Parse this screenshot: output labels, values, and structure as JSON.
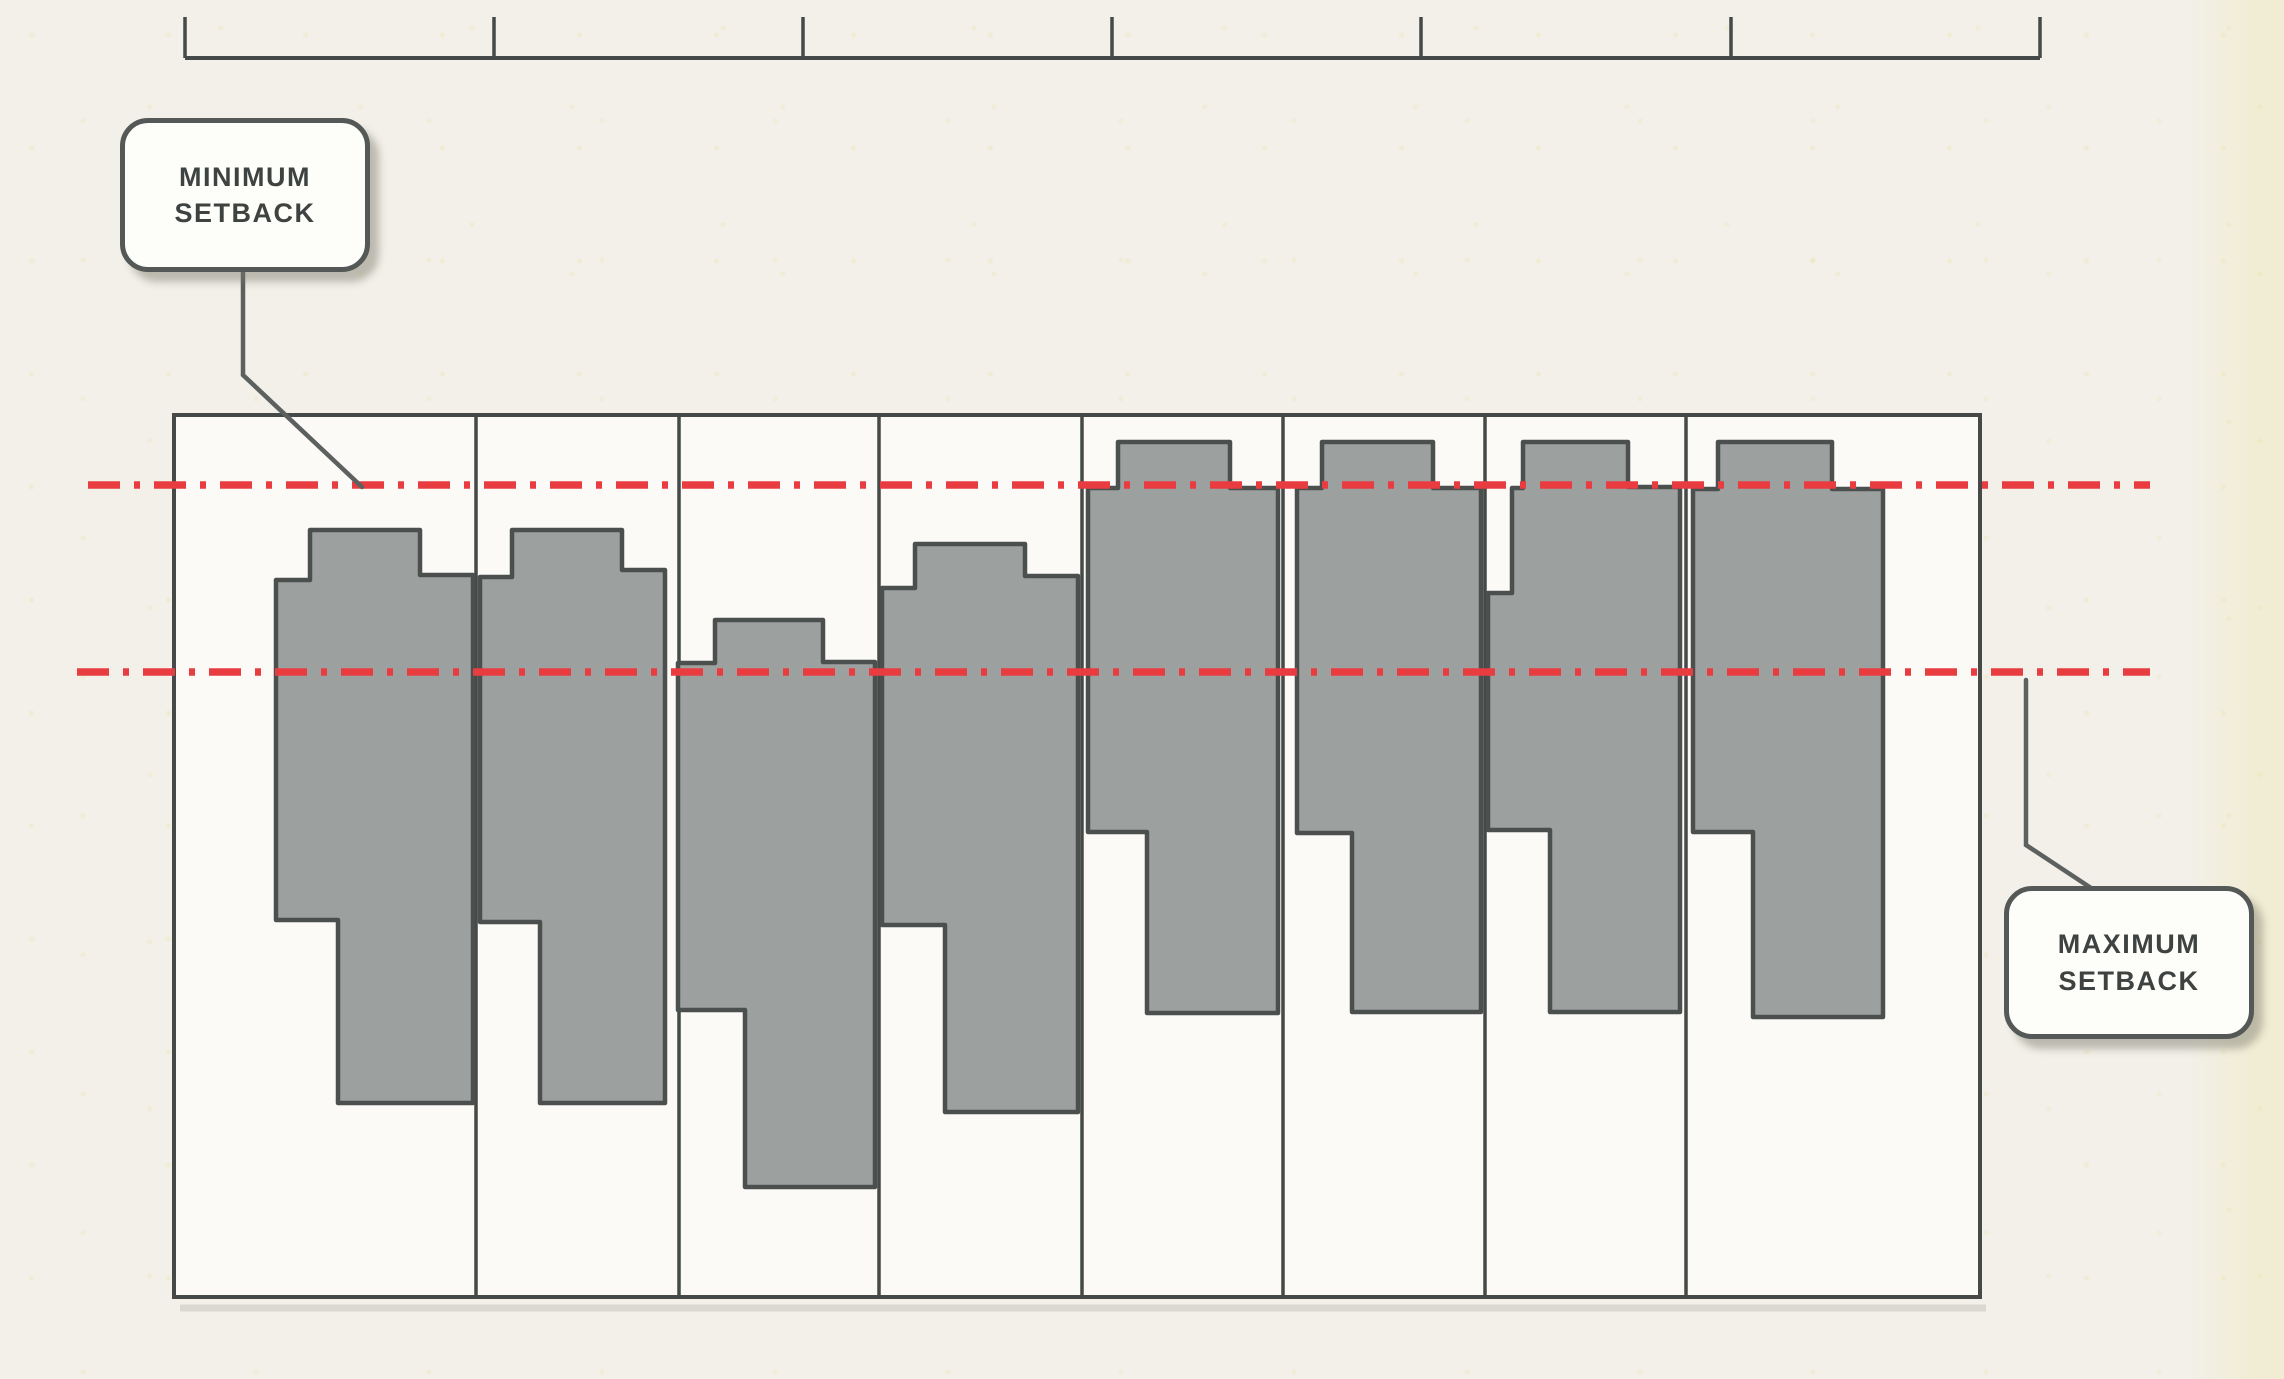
{
  "labels": {
    "minimum_setback_line1": "MINIMUM",
    "minimum_setback_line2": "SETBACK",
    "maximum_setback_line1": "MAXIMUM",
    "maximum_setback_line2": "SETBACK"
  },
  "colors": {
    "background": "#f2f0e8",
    "block_fill": "#fbfaf6",
    "line_dark": "#454947",
    "building_fill": "#9ca19f",
    "building_stroke": "#4b4f4d",
    "setback_red": "#e93c41",
    "leader": "#5c605e",
    "shadow": "#c9c6bb"
  },
  "diagram": {
    "canvas": {
      "width": 2284,
      "height": 1379
    },
    "ruler": {
      "y": 58,
      "x1": 185,
      "x2": 2040,
      "tick_top": 17,
      "ticks": [
        185,
        494,
        803,
        1112,
        1421,
        1731,
        2040
      ]
    },
    "block": {
      "x": 174,
      "y": 415,
      "width": 1806,
      "height": 882
    },
    "lot_dividers": [
      476,
      679,
      879,
      1082,
      1283,
      1485,
      1686
    ],
    "setback_lines": [
      {
        "id": "minimum-setback-line",
        "y": 485,
        "x1": 88,
        "x2": 2150
      },
      {
        "id": "maximum-setback-line",
        "y": 672,
        "x1": 77,
        "x2": 2150
      }
    ],
    "dash_pattern": "32 14 6 14",
    "buildings": [
      {
        "id": "building-1",
        "points": [
          [
            276,
            580
          ],
          [
            310,
            580
          ],
          [
            310,
            530
          ],
          [
            420,
            530
          ],
          [
            420,
            575
          ],
          [
            473,
            575
          ],
          [
            473,
            1103
          ],
          [
            338,
            1103
          ],
          [
            338,
            920
          ],
          [
            276,
            920
          ]
        ]
      },
      {
        "id": "building-2",
        "points": [
          [
            480,
            577
          ],
          [
            512,
            577
          ],
          [
            512,
            530
          ],
          [
            622,
            530
          ],
          [
            622,
            570
          ],
          [
            665,
            570
          ],
          [
            665,
            1103
          ],
          [
            540,
            1103
          ],
          [
            540,
            922
          ],
          [
            480,
            922
          ]
        ]
      },
      {
        "id": "building-3",
        "points": [
          [
            678,
            663
          ],
          [
            715,
            663
          ],
          [
            715,
            620
          ],
          [
            823,
            620
          ],
          [
            823,
            662
          ],
          [
            875,
            662
          ],
          [
            875,
            1187
          ],
          [
            745,
            1187
          ],
          [
            745,
            1010
          ],
          [
            678,
            1010
          ]
        ]
      },
      {
        "id": "building-4",
        "points": [
          [
            882,
            588
          ],
          [
            915,
            588
          ],
          [
            915,
            544
          ],
          [
            1025,
            544
          ],
          [
            1025,
            576
          ],
          [
            1078,
            576
          ],
          [
            1078,
            1112
          ],
          [
            945,
            1112
          ],
          [
            945,
            925
          ],
          [
            882,
            925
          ]
        ]
      },
      {
        "id": "building-5",
        "points": [
          [
            1088,
            488
          ],
          [
            1118,
            488
          ],
          [
            1118,
            442
          ],
          [
            1230,
            442
          ],
          [
            1230,
            488
          ],
          [
            1278,
            488
          ],
          [
            1278,
            1013
          ],
          [
            1147,
            1013
          ],
          [
            1147,
            832
          ],
          [
            1088,
            832
          ]
        ]
      },
      {
        "id": "building-6",
        "points": [
          [
            1297,
            488
          ],
          [
            1322,
            488
          ],
          [
            1322,
            442
          ],
          [
            1433,
            442
          ],
          [
            1433,
            488
          ],
          [
            1481,
            488
          ],
          [
            1481,
            1012
          ],
          [
            1352,
            1012
          ],
          [
            1352,
            833
          ],
          [
            1297,
            833
          ]
        ]
      },
      {
        "id": "building-7",
        "points": [
          [
            1512,
            488
          ],
          [
            1523,
            488
          ],
          [
            1523,
            442
          ],
          [
            1628,
            442
          ],
          [
            1628,
            487
          ],
          [
            1680,
            487
          ],
          [
            1680,
            1012
          ],
          [
            1550,
            1012
          ],
          [
            1550,
            830
          ],
          [
            1488,
            830
          ],
          [
            1488,
            593
          ],
          [
            1512,
            593
          ]
        ]
      },
      {
        "id": "building-8",
        "points": [
          [
            1693,
            489
          ],
          [
            1718,
            489
          ],
          [
            1718,
            442
          ],
          [
            1832,
            442
          ],
          [
            1832,
            489
          ],
          [
            1883,
            489
          ],
          [
            1883,
            1017
          ],
          [
            1753,
            1017
          ],
          [
            1753,
            832
          ],
          [
            1693,
            832
          ]
        ]
      }
    ],
    "leaders": [
      {
        "id": "leader-minimum",
        "points": [
          [
            243,
            272
          ],
          [
            243,
            375
          ],
          [
            362,
            487
          ]
        ]
      },
      {
        "id": "leader-maximum",
        "points": [
          [
            2026,
            680
          ],
          [
            2026,
            845
          ],
          [
            2091,
            888
          ]
        ]
      }
    ]
  }
}
